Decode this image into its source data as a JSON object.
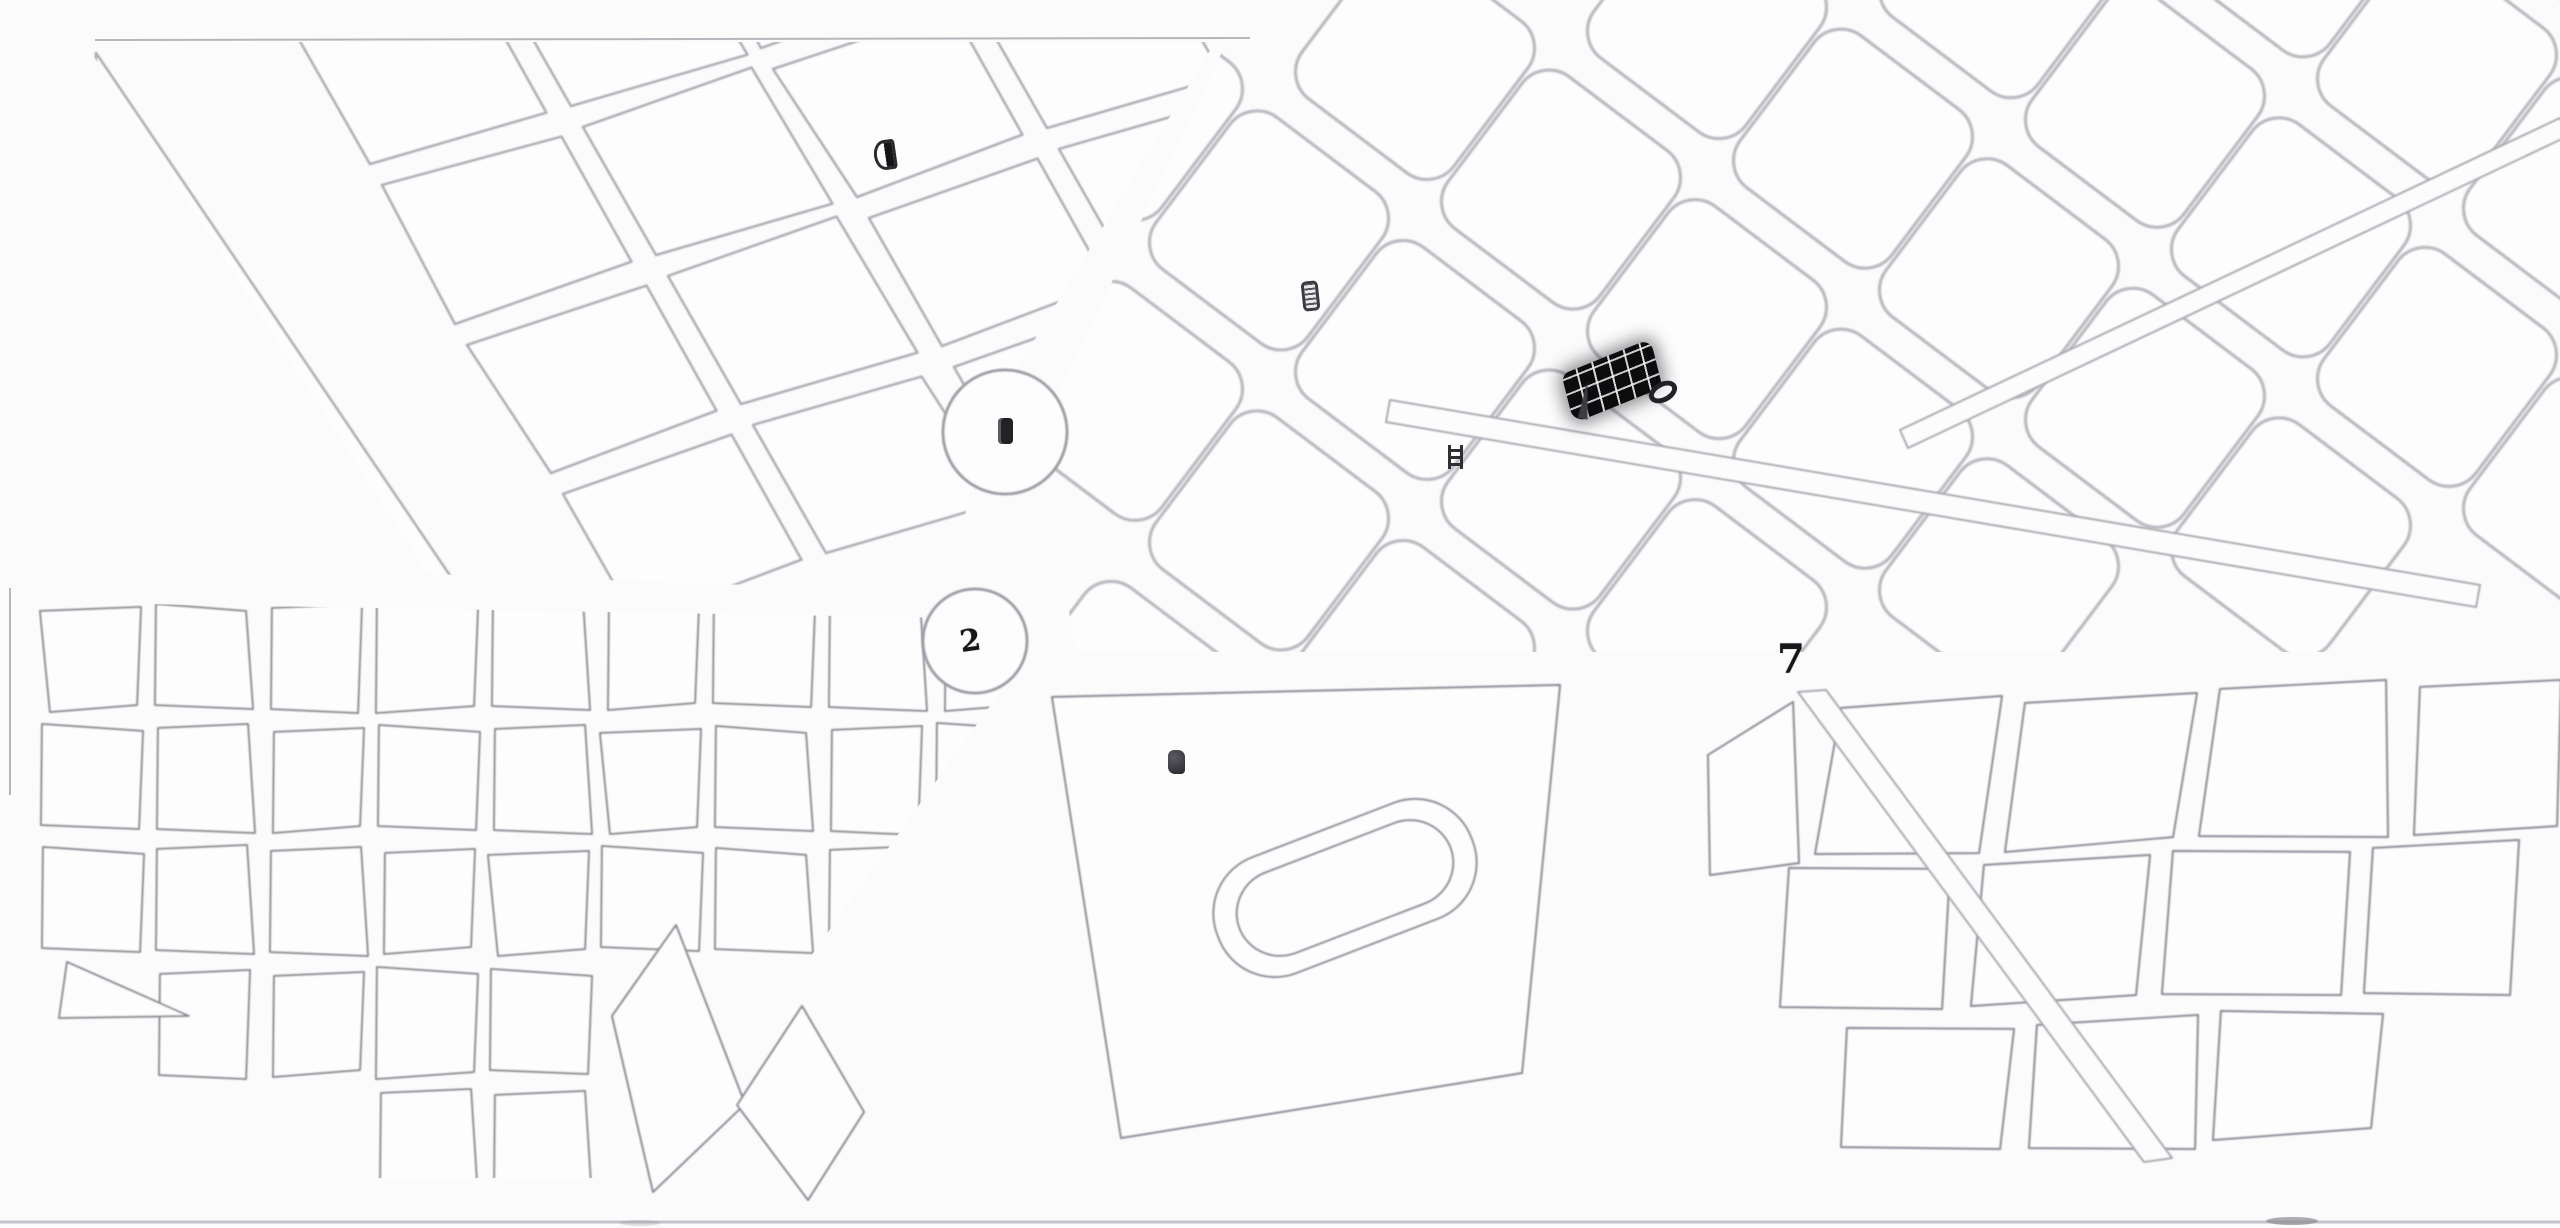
{
  "canvas": {
    "width": 2560,
    "height": 1228,
    "background": "#fbfbfc"
  },
  "palette": {
    "stroke_light": "#bcbcc2",
    "stroke_medium": "#adadb5",
    "stroke_dark": "#8a8a92",
    "ink": "#151517",
    "paper_edge": "#c3c3c9"
  },
  "markers": [
    {
      "id": "half-disc-marker",
      "kind": "half-disc",
      "label": "",
      "x": 885,
      "y": 155,
      "w": 22,
      "h": 30,
      "rot": -8
    },
    {
      "id": "framed-marker",
      "kind": "framed",
      "label": "",
      "x": 1310,
      "y": 296,
      "w": 17,
      "h": 30,
      "rot": -6
    },
    {
      "id": "ladder-marker",
      "kind": "ladder",
      "label": "",
      "x": 1455,
      "y": 457,
      "w": 15,
      "h": 24,
      "rot": 0
    },
    {
      "id": "plaza-1-marker",
      "kind": "blob",
      "label": "1",
      "x": 1005,
      "y": 431,
      "w": 15,
      "h": 26,
      "rot": 0
    },
    {
      "id": "plaza-2-marker",
      "kind": "digit",
      "label": "2",
      "x": 975,
      "y": 641,
      "w": 30,
      "h": 30,
      "rot": -8,
      "size": 30
    },
    {
      "id": "block-5-marker",
      "kind": "blob2",
      "label": "5",
      "x": 1176,
      "y": 762,
      "w": 17,
      "h": 24,
      "rot": 0
    },
    {
      "id": "junction-7-marker",
      "kind": "digit",
      "label": "7",
      "x": 1797,
      "y": 660,
      "w": 40,
      "h": 40,
      "rot": 0,
      "size": 40
    },
    {
      "id": "needle-marker",
      "kind": "needle",
      "label": "",
      "x": 1585,
      "y": 400,
      "w": 11,
      "h": 38,
      "rot": 7
    },
    {
      "id": "oval-marker",
      "kind": "oval",
      "label": "0",
      "x": 1663,
      "y": 392,
      "w": 30,
      "h": 20,
      "rot": -28
    }
  ],
  "landmarks": {
    "dark_building": {
      "x": 1612,
      "y": 381,
      "w": 96,
      "h": 50,
      "rot": -22
    },
    "plaza_circle_a": {
      "cx": 1005,
      "cy": 432,
      "r": 62
    },
    "plaza_circle_b": {
      "cx": 975,
      "cy": 641,
      "r": 52
    },
    "stadium": {
      "cx": 1345,
      "cy": 888,
      "w": 272,
      "h": 124,
      "w2": 226,
      "h2": 86,
      "rot": -21
    }
  },
  "edges": {
    "top_line": {
      "x1": 95,
      "y1": 40,
      "x2": 1250,
      "y2": 38
    },
    "left_tick": {
      "x1": 10,
      "y1": 588,
      "x2": 10,
      "y2": 795
    },
    "bottom_line": {
      "y": 1222
    },
    "smudges": [
      {
        "x": 2292,
        "y": 1221,
        "rx": 26,
        "ry": 4,
        "opacity": 0.7
      },
      {
        "x": 640,
        "y": 1223,
        "rx": 20,
        "ry": 3,
        "opacity": 0.25
      }
    ]
  }
}
